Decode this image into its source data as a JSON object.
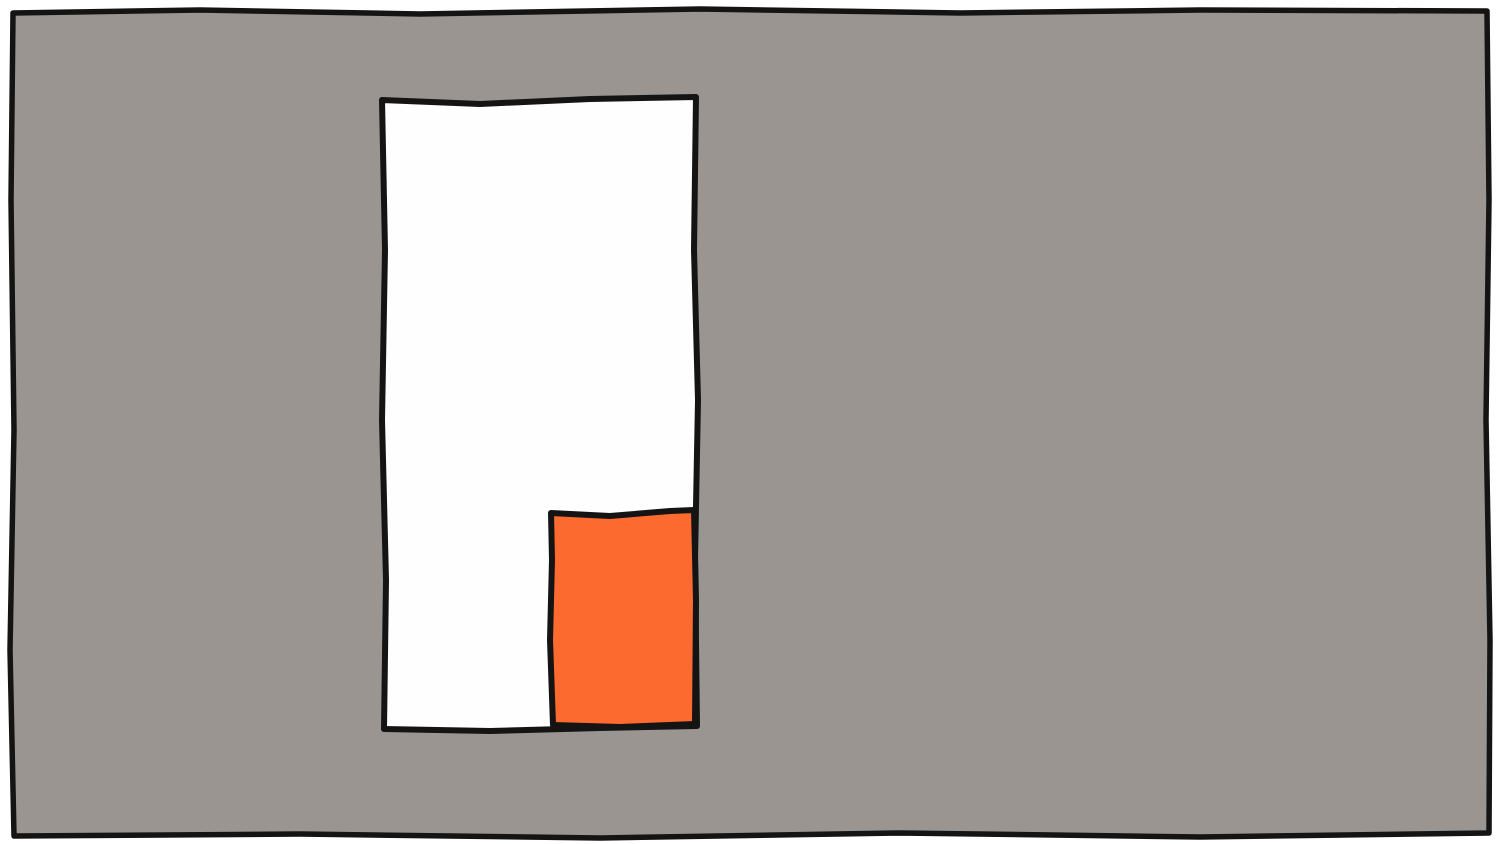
{
  "colors": {
    "page_background": "#ffffff",
    "wall_gray": "#9b9591",
    "panel_white": "#fefefe",
    "block_orange": "#fc6a30",
    "ink_black": "#141414"
  }
}
